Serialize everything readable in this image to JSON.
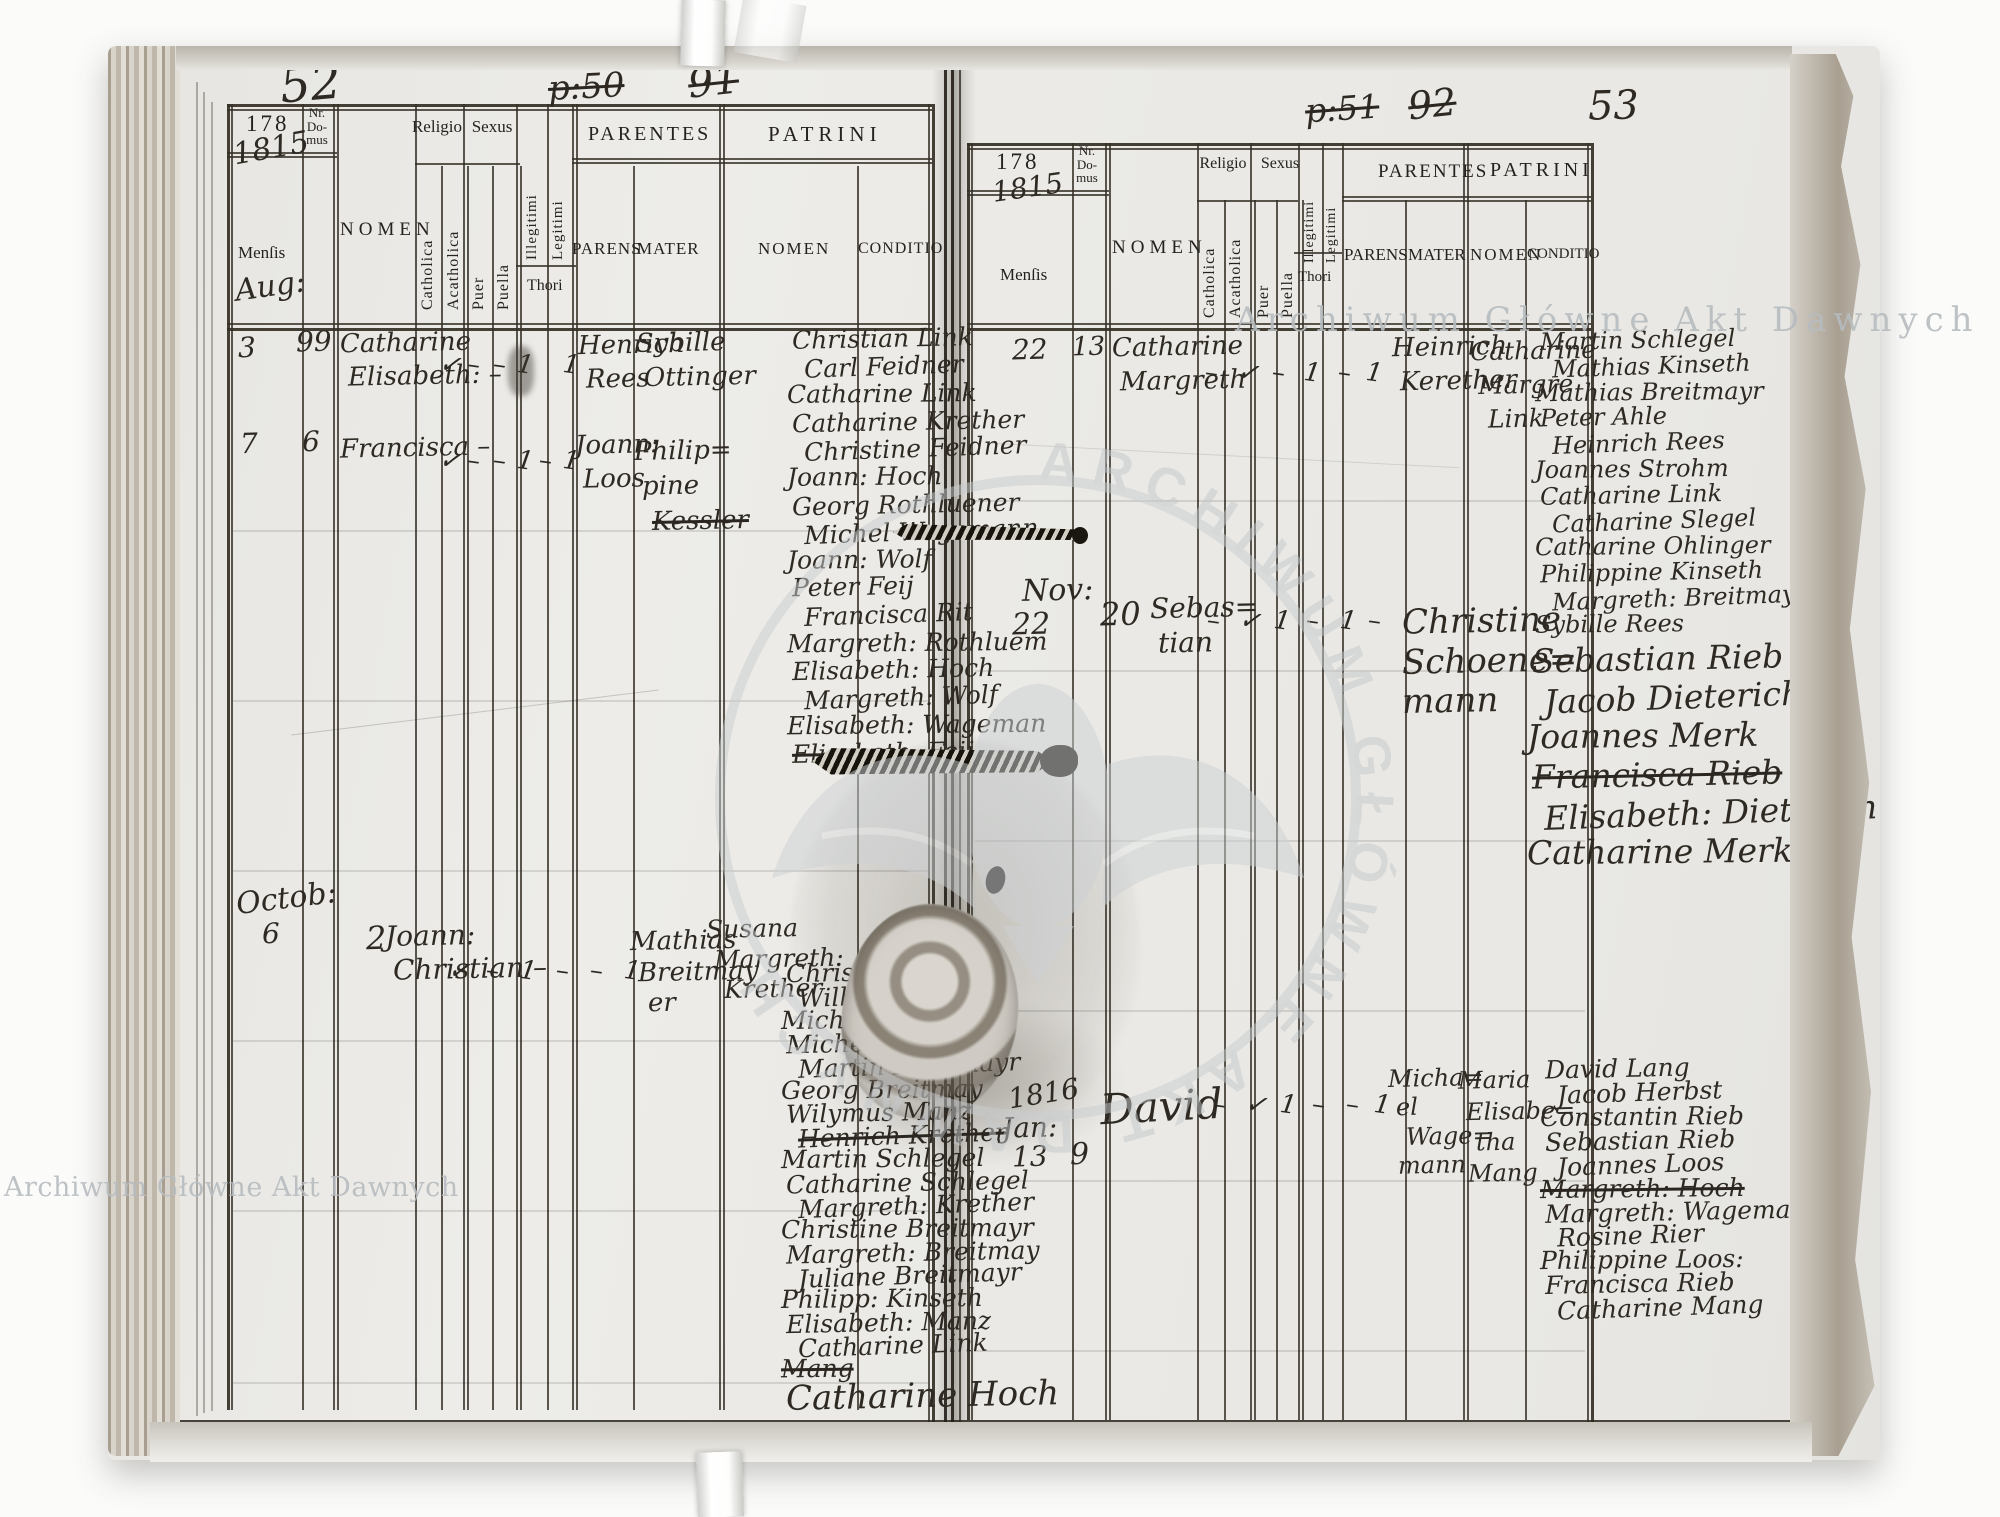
{
  "watermark_text": "Archiwum Główne Akt Dawnych",
  "header": {
    "year_printed": "178",
    "nr_domus": "Nr.\nDo-\nmus",
    "mensis": "Menſis",
    "nomen": "NOMEN",
    "religio": "Religio",
    "catholica": "Catholica",
    "acatholica": "Acatholica",
    "sexus": "Sexus",
    "puer": "Puer",
    "puella": "Puella",
    "illegitimi": "Illegitimi",
    "legitimi": "Legitimi",
    "thori": "Thori",
    "parentes": "PARENTES",
    "parens": "PARENS",
    "mater": "MATER",
    "patrini": "PATRINI",
    "patrini_nomen": "NOMEN",
    "conditio": "CONDITIO"
  },
  "left": {
    "page_number": "52",
    "nav_note": "p:50",
    "nav_note_2": "91",
    "year_hw": "1815",
    "month_first": "Aug:",
    "entries": [
      {
        "mensis": "3",
        "nr": "99",
        "nomen": [
          "Catharine",
          "Elisabeth: –"
        ],
        "marks": [
          "✓",
          "–",
          "–",
          "1",
          "",
          "1"
        ],
        "parens": [
          "Henrich",
          "Rees"
        ],
        "mater": [
          "Sybille",
          "Ottinger"
        ]
      },
      {
        "mensis": "7",
        "nr": "6",
        "nomen": [
          "Francisca –"
        ],
        "marks": [
          "✓",
          "–",
          "–",
          "1",
          "–",
          "1"
        ],
        "parens": [
          "Joann:",
          "Loos"
        ],
        "mater": [
          "Philip=",
          "pine",
          {
            "text": "Kessler",
            "cls": "struck"
          }
        ]
      },
      {
        "month": "Octob:",
        "mensis": "6",
        "nr": "2",
        "nomen": [
          "Joann:",
          "Christian –"
        ],
        "marks": [
          "✓",
          "–",
          "1",
          "–",
          "–",
          "1"
        ],
        "parens": [
          "Mathias",
          "Breitmay",
          "er"
        ],
        "mater": [
          "Susana",
          "Margreth:",
          "Krether"
        ]
      }
    ],
    "patrini_first": [
      "Christian Link",
      "Carl Feidner",
      "Catharine Link",
      "Catharine Krether",
      "Christine Feidner",
      "Joann: Hoch",
      "Georg Rothluener",
      "Michel Wagemann",
      "Joann: Wolf",
      "Peter Feij",
      "Francisca Rit",
      "Margreth: Rothluem",
      "Elisabeth: Hoch",
      "Margreth: Wolf",
      "Elisabeth: Wageman",
      {
        "text": "Elisabeth: Feij",
        "cls": "struck"
      }
    ],
    "patrini_second": [
      "Christian",
      "Wilhelm Hoch",
      "Michel Kinseth",
      "Michel Breitmayr",
      "Martin Breitmayr",
      "Georg Breitmay",
      "Wilymus Manz",
      {
        "text": "Henrich Krether",
        "cls": "struck"
      },
      "Martin Schlegel",
      "Catharine Schlegel",
      "Margreth: Krether",
      "Christine Breitmayr",
      "Margreth: Breitmay",
      "Juliane Breitmayr",
      "Philipp: Kinseth",
      "Elisabeth: Manz",
      "Catharine Link",
      {
        "text": "Mang",
        "cls": "struck"
      },
      {
        "text": "Catharine Hoch",
        "cls": "big"
      }
    ]
  },
  "right": {
    "page_number": "53",
    "nav_note": "p:51",
    "nav_note_2": "92",
    "year_hw": "1815",
    "entries": [
      {
        "mensis": "22",
        "nr": "13",
        "nomen": [
          "Catharine",
          "Margreth"
        ],
        "marks": [
          "–",
          "✓",
          "–",
          "1",
          "–",
          "1"
        ],
        "parens": [
          "Heinrich",
          "Kerether"
        ],
        "mater": [
          "Catharine",
          "Margre",
          "Link"
        ]
      },
      {
        "month": "Nov:",
        "mensis": "22",
        "nr": "20",
        "nomen": [
          "Sebas=",
          "tian"
        ],
        "marks": [
          "–",
          "✓",
          "1",
          "–",
          "1",
          "–"
        ],
        "parens": [],
        "mater": [
          "Christine",
          "Schoene=",
          "mann"
        ]
      },
      {
        "year": "1816",
        "month": "Jan:",
        "mensis": "13",
        "nr": "9",
        "nomen": [
          "David"
        ],
        "marks": [
          "–",
          "✓",
          "1",
          "–",
          "–",
          "1"
        ],
        "parens": [
          "Micha=",
          "el",
          "Wage=",
          "mann"
        ],
        "mater": [
          "Maria",
          "Elisabe=",
          "tha",
          "Mang"
        ]
      }
    ],
    "patrini_first": [
      "Martin Schlegel",
      "Mathias Kinseth",
      "Mathias Breitmayr",
      "Peter Ahle",
      "Heinrich Rees",
      "Joannes Strohm",
      "Catharine Link",
      "Catharine Slegel",
      "Catharine Ohlinger",
      "Philippine Kinseth",
      "Margreth: Breitmayr",
      "Sybille Rees"
    ],
    "patrini_second": [
      "Sebastian Rieb",
      "Jacob Dieterich",
      "Joannes Merk",
      {
        "text": "Francisca Rieb",
        "cls": "struck"
      },
      "Elisabeth: Dieterich",
      "Catharine Merk"
    ],
    "patrini_third": [
      "David Lang",
      "Jacob Herbst",
      "Constantin Rieb",
      "Sebastian Rieb",
      "Joannes Loos",
      {
        "text": "Margreth: Hoch",
        "cls": "struck"
      },
      "Margreth: Wagemann",
      "Rosine Rier",
      "Philippine Loos:",
      "Francisca Rieb",
      "Catharine Mang"
    ]
  }
}
